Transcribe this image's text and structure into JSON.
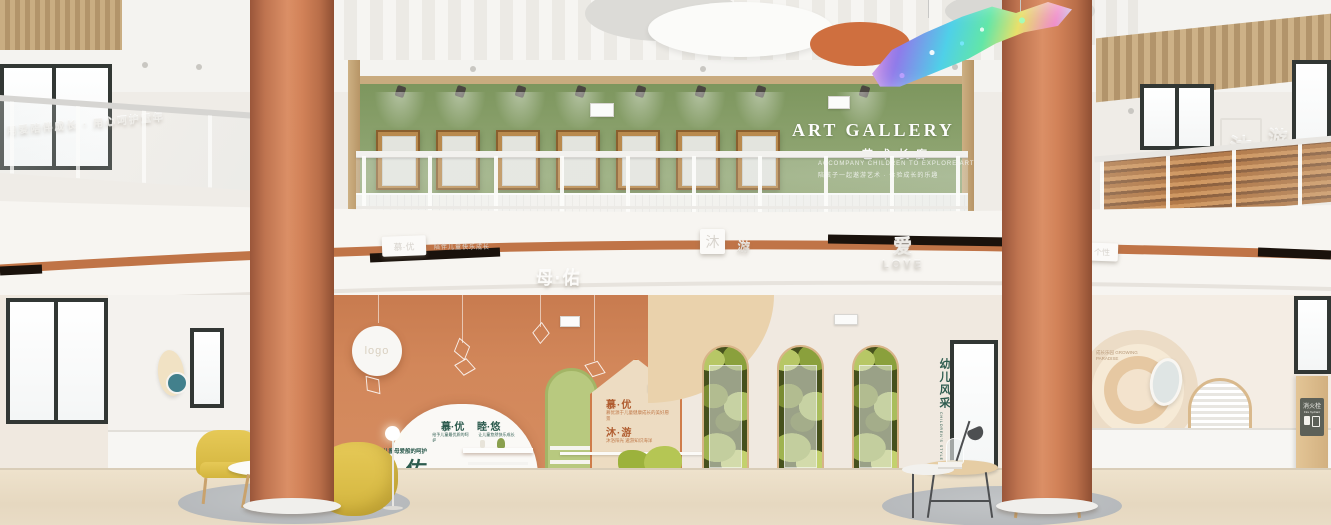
{
  "artGallery": {
    "title": "ART GALLERY",
    "subtitle": "艺术长廊",
    "taglineEn": "ACCOMPANY CHILDREN TO EXPLORE ART",
    "taglineCn": "陪孩子一起遨游艺术 · 体验成长的乐趣"
  },
  "upperLeft": {
    "slogan": "用爱陪伴成长 · 用心呵护童年"
  },
  "upperRight": {
    "mu": "沐",
    "you": "游"
  },
  "fascia": {
    "boxLabel": "慕·优",
    "boxCaption": "陪伴儿童快乐成长",
    "motherTitle": "母·佑",
    "mu": "沐",
    "you": "游",
    "loveCn": "爱",
    "loveEn": "LOVE",
    "rightChar": "育",
    "rightBox": "个性"
  },
  "terracotta": {
    "logo": "logo",
    "domeTitle1": "慕·优",
    "domeTitle2": "睦·悠",
    "domeCaption1": "给予儿童最优质的呵护",
    "domeCaption2": "让儿童悠然快乐成长",
    "motherCaption": "给予儿童母爱般的呵护",
    "motherTitle": "母·佑",
    "houseTitle1": "慕·优",
    "houseCaption1": "慕优源于儿童健康成长的美好愿景",
    "houseTitle2": "沐·游",
    "houseCaption2": "沐浴阳光 遨游知识海洋"
  },
  "centerWall": {
    "styleCn": "幼儿风采",
    "styleEn": "CHILDREN'S STYLE"
  },
  "rightWall": {
    "muralCaption": "成长乐园 GROWING PARADISE",
    "fireCn": "消火栓",
    "fireEn": "Fire hydrant"
  }
}
